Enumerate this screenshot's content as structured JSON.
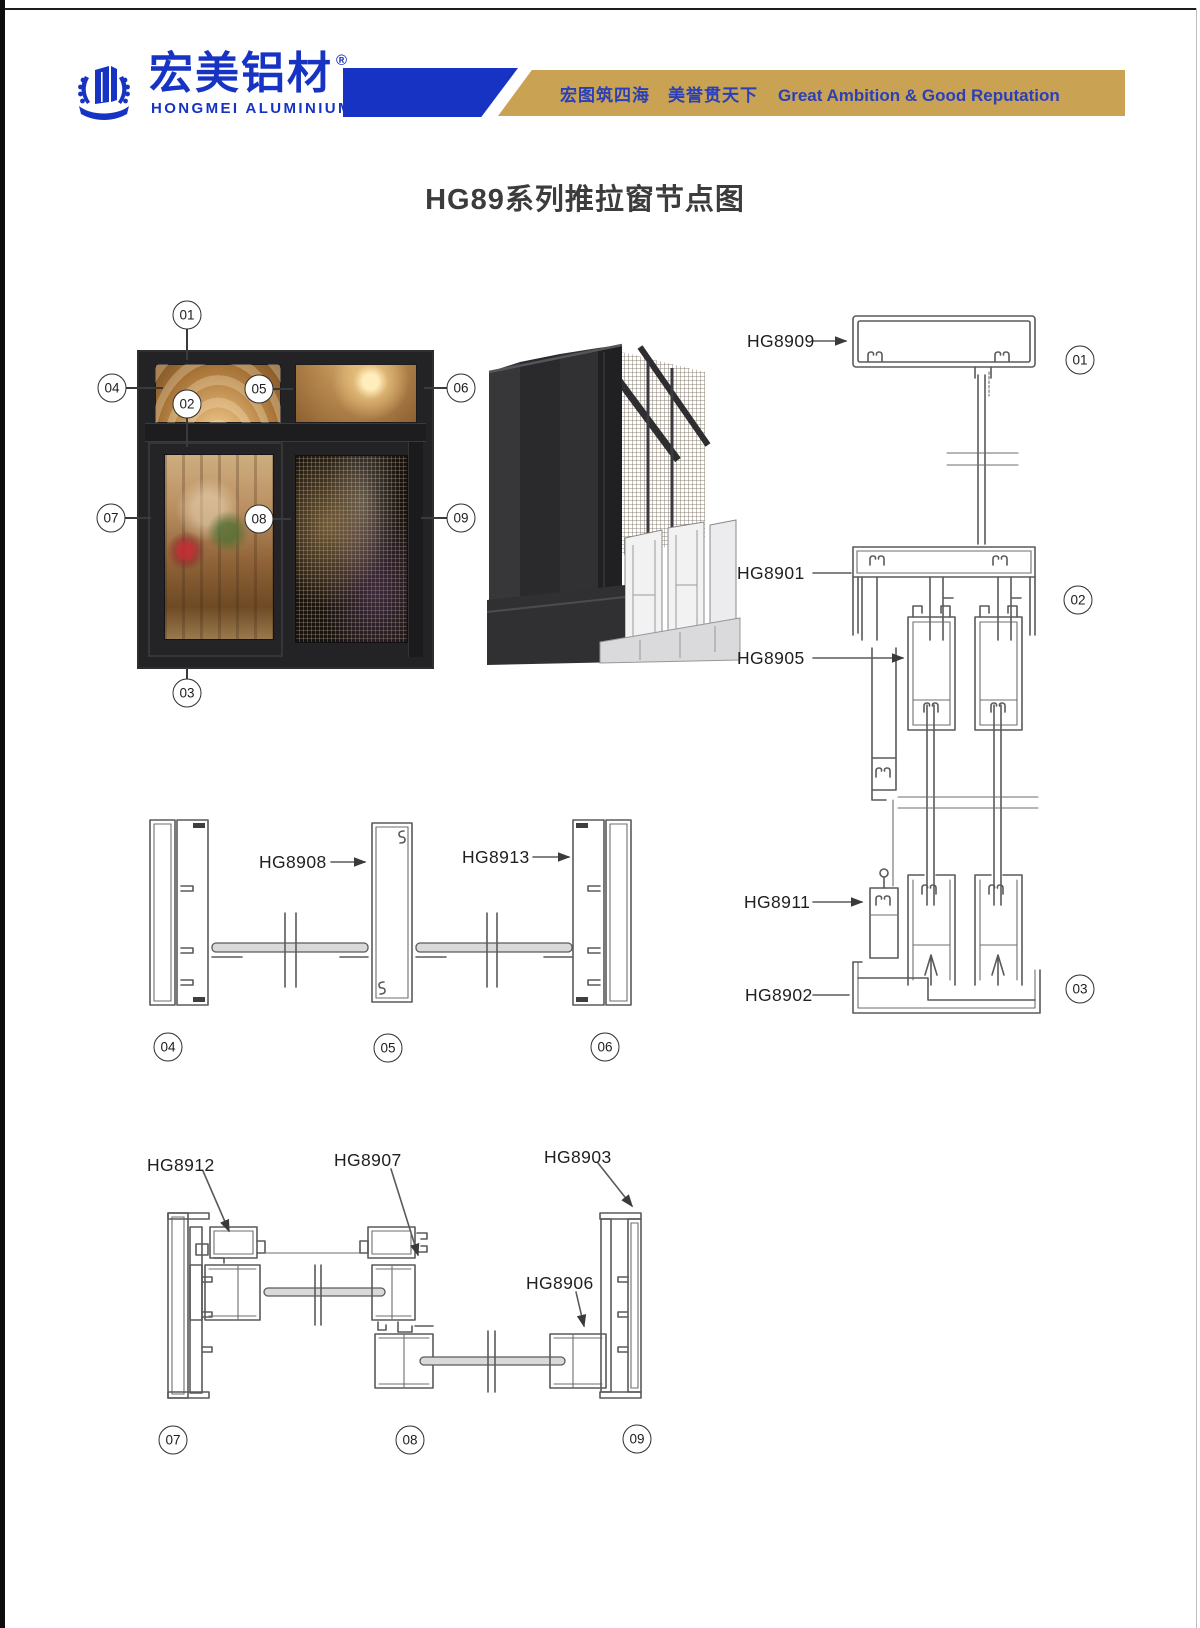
{
  "header": {
    "brand_cn": "宏美铝材",
    "registered_mark": "®",
    "brand_en": "HONGMEI ALUMINIUM",
    "slogan_cn": "宏图筑四海　美誉贯天下",
    "slogan_en": "Great Ambition & Good Reputation"
  },
  "title": "HG89系列推拉窗节点图",
  "callouts": {
    "c01": "01",
    "c02": "02",
    "c03": "03",
    "c04": "04",
    "c05": "05",
    "c06": "06",
    "c07": "07",
    "c08": "08",
    "c09": "09"
  },
  "part_labels": {
    "hg8909": "HG8909",
    "hg8901": "HG8901",
    "hg8905": "HG8905",
    "hg8911": "HG8911",
    "hg8902": "HG8902",
    "hg8908": "HG8908",
    "hg8913": "HG8913",
    "hg8912": "HG8912",
    "hg8907": "HG8907",
    "hg8903": "HG8903",
    "hg8906": "HG8906"
  },
  "colors": {
    "brand_blue": "#1733c4",
    "banner_gold": "#c9a353",
    "slogan_blue": "#2a3fb8",
    "drawing_line_gray": "#5a5a5a"
  }
}
